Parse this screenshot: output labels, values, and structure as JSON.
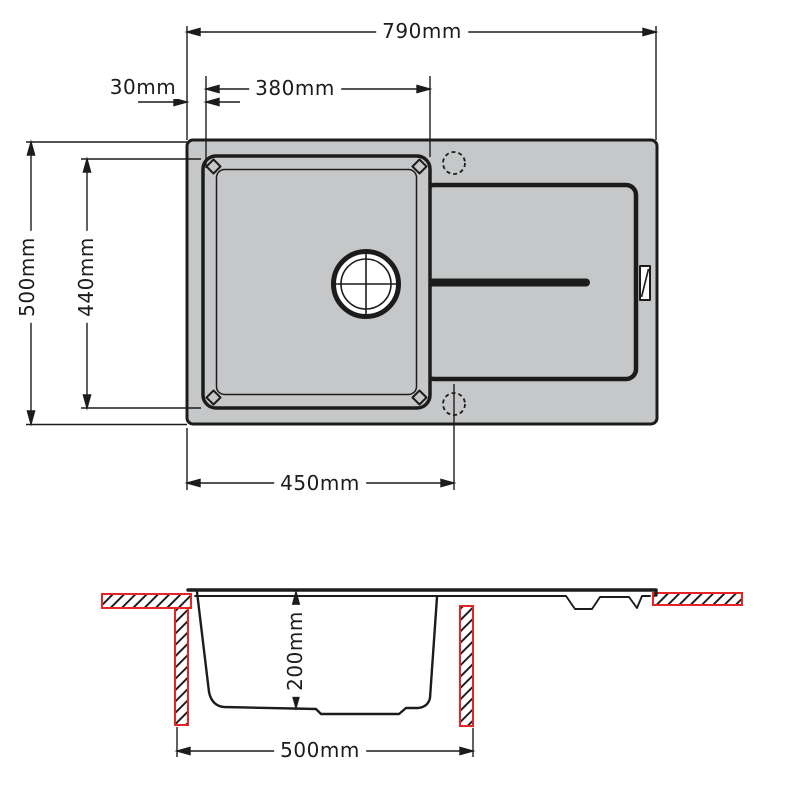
{
  "drawing_title": "Kitchen sink with drainer - dimensioned technical drawing",
  "colors": {
    "line": "#1c1c1c",
    "sink_fill": "#c6c7c8",
    "worktop_red": "#e42528",
    "background": "#ffffff"
  },
  "dims": {
    "overall_width": {
      "label": "790mm",
      "view": "plan"
    },
    "edge_to_bowl": {
      "label": "30mm",
      "view": "plan"
    },
    "bowl_width": {
      "label": "380mm",
      "view": "plan"
    },
    "overall_depth": {
      "label": "500mm",
      "view": "plan"
    },
    "bowl_length": {
      "label": "440mm",
      "view": "plan"
    },
    "bowl_section_width": {
      "label": "450mm",
      "view": "plan"
    },
    "bowl_depth": {
      "label": "200mm",
      "view": "section"
    },
    "cutout_width": {
      "label": "500mm",
      "view": "section"
    }
  }
}
